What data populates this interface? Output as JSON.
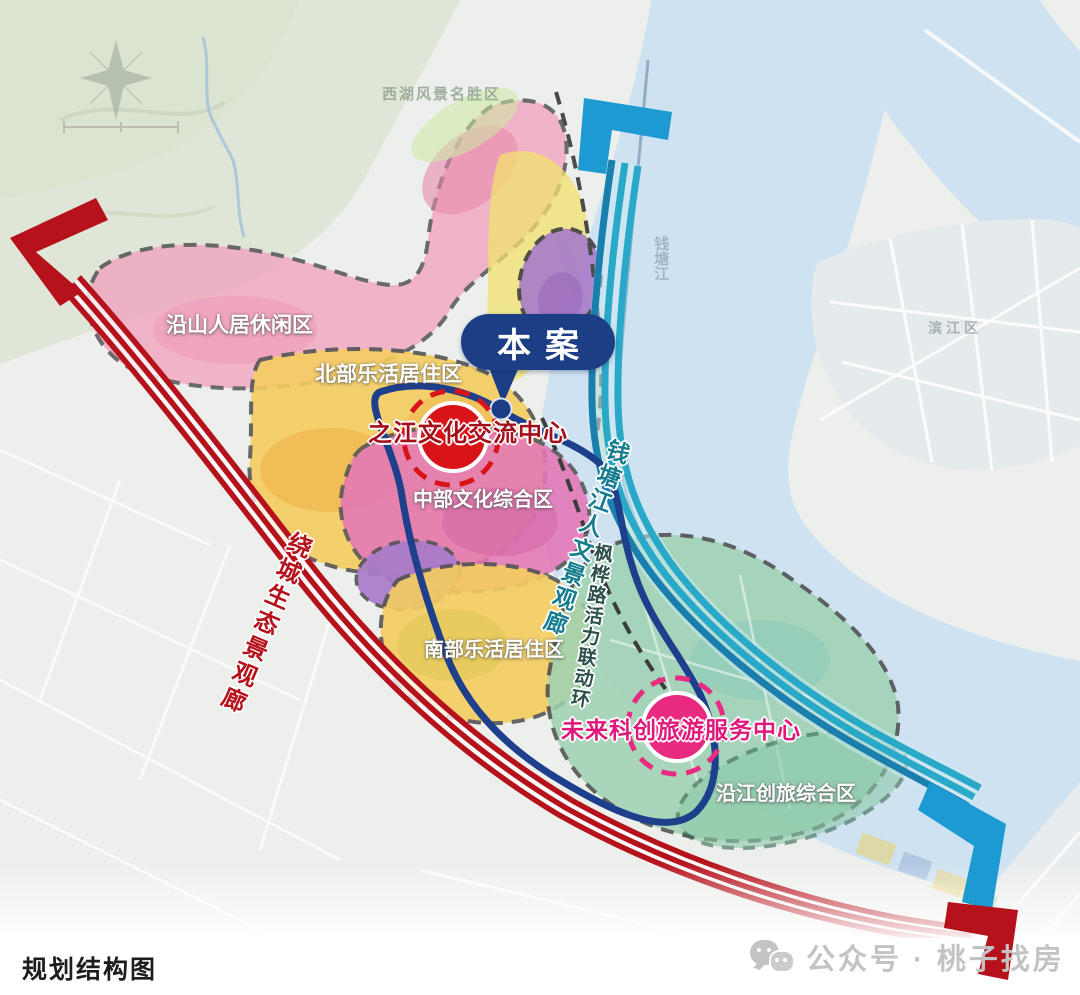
{
  "map": {
    "callout": {
      "label": "本案"
    },
    "centers": {
      "zhijiang": {
        "label": "之江文化交流中心"
      },
      "weilai": {
        "label": "未来科创旅游服务中心"
      }
    },
    "zones": {
      "yanshan": {
        "label": "沿山人居休闲区"
      },
      "beibu": {
        "label": "北部乐活居住区"
      },
      "zhongbu": {
        "label": "中部文化综合区"
      },
      "nanbu": {
        "label": "南部乐活居住区"
      },
      "yanjiang": {
        "label": "沿江创旅综合区"
      }
    },
    "corridors": {
      "raocheng": {
        "label": "绕城生态景观廊",
        "color": "#b5121b"
      },
      "qiantang": {
        "label": "钱塘江人文景观廊",
        "color": "#157d8e"
      },
      "fenghua": {
        "label": "枫桦路活力联动环",
        "color": "#2b4f49"
      }
    },
    "context": {
      "xihu": "西湖风景名胜区",
      "binjiang": "滨江区",
      "qiantangjiang": "钱塘江"
    }
  },
  "colors": {
    "navy": "#1c3e85",
    "corridor_red": "#b5121b",
    "corridor_teal": "#2aa8c8",
    "center_red": "#d91418",
    "center_pink": "#e82a80"
  },
  "icons": {
    "watermark_icon": "wechat-bubbles"
  },
  "footer": {
    "caption": "规划结构图"
  },
  "watermark": {
    "text": "公众号 · 桃子找房"
  }
}
